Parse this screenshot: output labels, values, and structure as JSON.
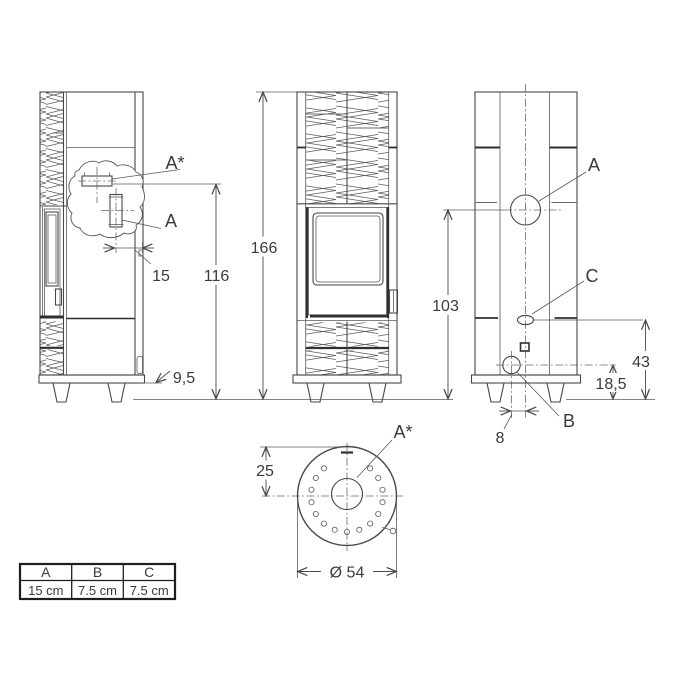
{
  "labels": {
    "flue_top": "A*",
    "flue_rear": "A",
    "outlet_a": "A",
    "outlet_b": "B",
    "outlet_c": "C"
  },
  "dims": {
    "total_height": "166",
    "rear_flue_height": "116",
    "flue_wall_offset": "15",
    "leg_height": "9,5",
    "back_outlet_height": "103",
    "outlet_c_height": "43",
    "outlet_b_height": "18,5",
    "outlet_b_offset": "8",
    "top_flue_offset": "25",
    "top_diameter": "Ø 54"
  },
  "table": {
    "headers": [
      "A",
      "B",
      "C"
    ],
    "values": [
      "15 cm",
      "7.5 cm",
      "7.5 cm"
    ]
  },
  "colors": {
    "line": "#4a4a4a",
    "text": "#3a3a3a",
    "background": "#ffffff"
  }
}
